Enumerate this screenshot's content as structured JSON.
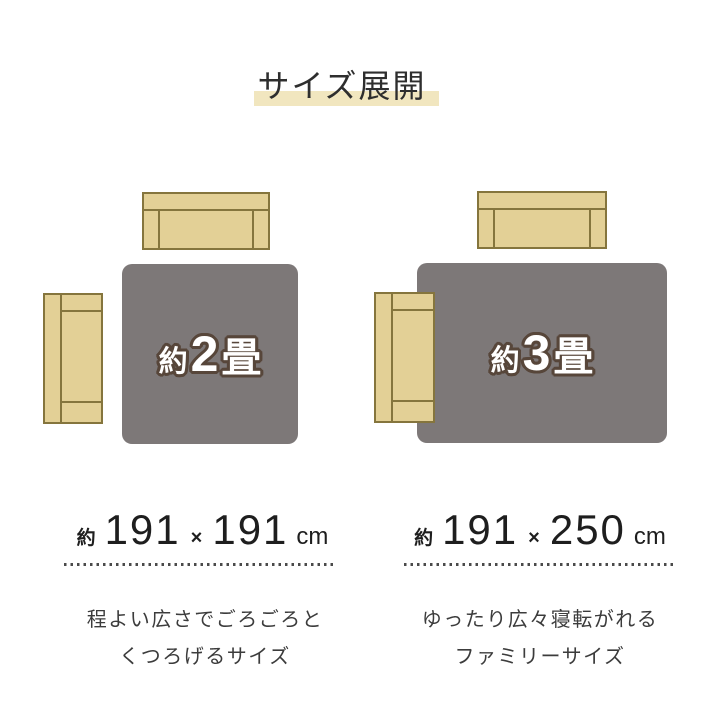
{
  "title": {
    "text": "サイズ展開"
  },
  "colors": {
    "title_highlight": "#f1e6bf",
    "title_text": "#2e2e2e",
    "rug": "#7d7878",
    "sofa_fill": "#e3d096",
    "sofa_outline": "#85753d",
    "rug_label_text": "#ffffff",
    "rug_label_outline": "#57463a",
    "size_text": "#1e1e1e",
    "dotted_divider": "#4a4a4a",
    "description_text": "#3c3c3c"
  },
  "variants": [
    {
      "label": {
        "prefix": "約",
        "number": "2",
        "unit": "畳"
      },
      "size": {
        "approx": "約",
        "width": "191",
        "times": "×",
        "length": "191",
        "unit": "cm"
      },
      "description_lines": {
        "0": "程よい広さでごろごろと",
        "1": "くつろげるサイズ"
      }
    },
    {
      "label": {
        "prefix": "約",
        "number": "3",
        "unit": "畳"
      },
      "size": {
        "approx": "約",
        "width": "191",
        "times": "×",
        "length": "250",
        "unit": "cm"
      },
      "description_lines": {
        "0": "ゆったり広々寝転がれる",
        "1": "ファミリーサイズ"
      }
    }
  ]
}
